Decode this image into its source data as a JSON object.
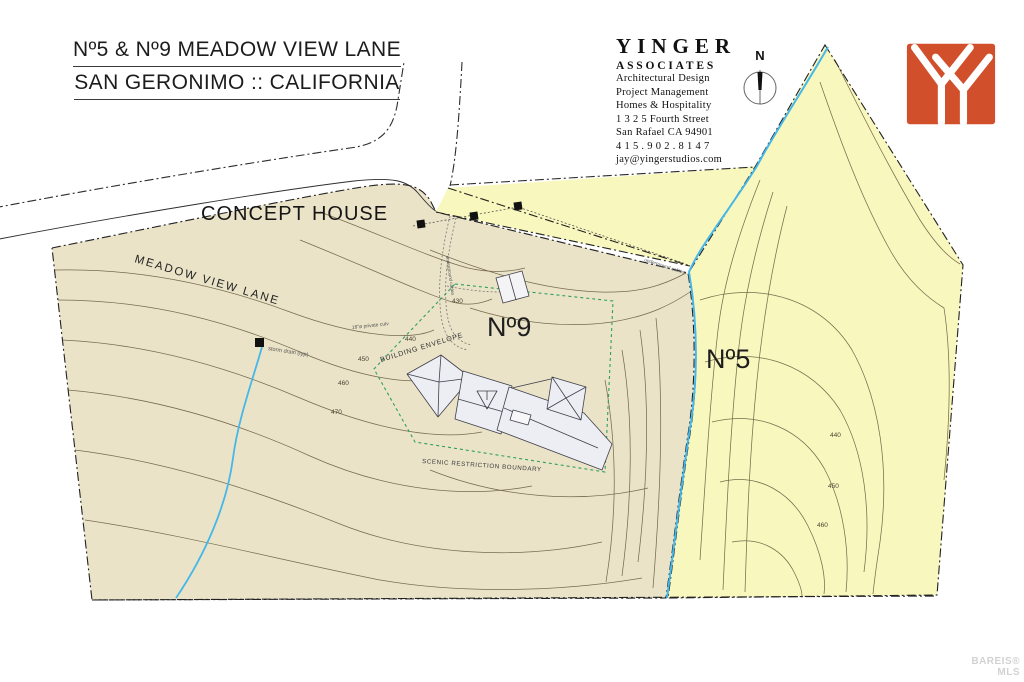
{
  "header": {
    "title_line1": "Nº5 & Nº9 MEADOW VIEW LANE",
    "title_line2": "SAN GERONIMO :: CALIFORNIA",
    "concept_label": "CONCEPT HOUSE"
  },
  "firm": {
    "name": "YINGER",
    "subname": "ASSOCIATES",
    "lines": [
      "Architectural Design",
      "Project Management",
      "Homes & Hospitality",
      "1 3 2 5   Fourth Street",
      "San Rafael  CA  94901",
      "4 1 5 . 9 0 2 . 8 1 4 7",
      "jay@yingerstudios.com"
    ]
  },
  "compass": {
    "north_label": "N"
  },
  "map": {
    "road_label": "MEADOW VIEW LANE",
    "parcel9_label": "Nº9",
    "parcel5_label": "Nº5",
    "building_envelope_label": "BUILDING ENVELOPE",
    "scenic_boundary_label": "SCENIC RESTRICTION BOUNDARY",
    "storm_drain_label": "storm drain (typ)",
    "culvert_label": "18\"ø private culv",
    "underground_label": "underground cables",
    "contours_no9": [
      "430",
      "440",
      "450",
      "460",
      "470"
    ],
    "contours_no5": [
      "440",
      "450",
      "460"
    ]
  },
  "watermark": {
    "line1": "BAREIS®",
    "line2": "MLS"
  },
  "colors": {
    "parcel9_fill": "#eae3c8",
    "parcel5_fill": "#f8f7bd",
    "creek": "#45b7e8",
    "envelope_green": "#2e9e62",
    "logo_orange": "#d14f2a",
    "contour_brown": "#6b5d42"
  }
}
